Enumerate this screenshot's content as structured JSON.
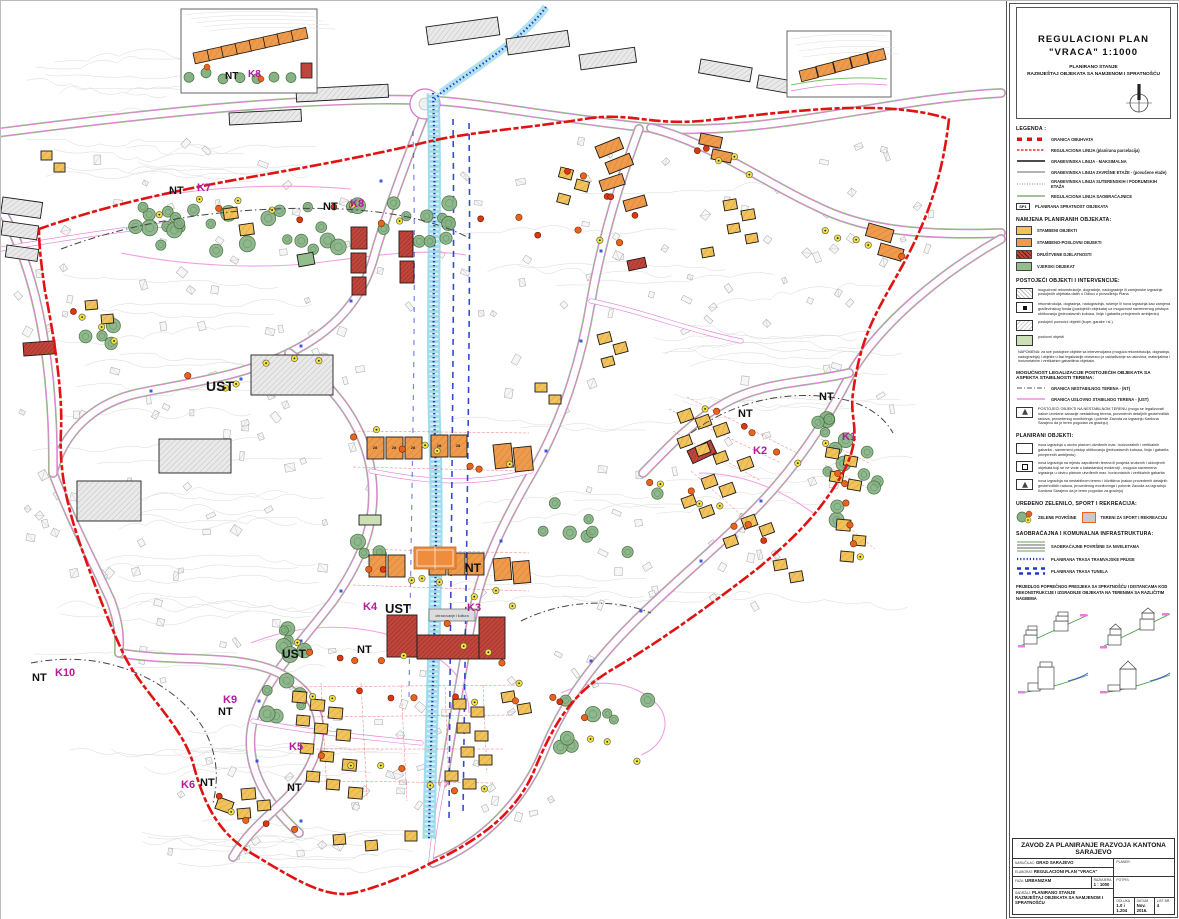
{
  "title_block": {
    "line1": "REGULACIONI  PLAN",
    "line2": "\"VRACA\"    1:1000",
    "line3": "PLANIRANO STANJE",
    "line4": "RAZMJEŠTAJ OBJEKATA SA NAMJENOM I SPRATNOŠĆU"
  },
  "legend": {
    "title": "LEGENDA :",
    "lines": [
      {
        "label": "GRANICA OBUHVATA"
      },
      {
        "label": "REGULACIONA LINIJA (planirana parcelacija)"
      },
      {
        "label": "GRAĐEVINSKA LINIJA - MAKSIMALNA"
      },
      {
        "label": "GRAĐEVINSKA LINIJA ZAVRŠNE ETAŽE - (povučene etaže)"
      },
      {
        "label": "GRAĐEVINSKA LINIJA SUTERENSKIH I PODRUMSKIH ETAŽA"
      },
      {
        "label": "REGULACIONA LINIJA SAOBRAĆAJNICE"
      }
    ],
    "sp1": {
      "tag": "SP1",
      "label": "PLANIRANA SPRATNOST OBJEKATA"
    }
  },
  "namjena": {
    "title": "NAMJENA PLANIRANIH OBJEKATA:",
    "items": [
      {
        "label": "STAMBENI  OBJEKTI",
        "color": "#F2C35A"
      },
      {
        "label": "STAMBENO-POSLOVNI  OBJEKTI",
        "color": "#F09A4B"
      },
      {
        "label": "DRUŠTVENE DJELATNOSTI",
        "color": "#C0463C"
      },
      {
        "label": "VJERSKI OBJEKAT",
        "color": "#93BD8C"
      }
    ]
  },
  "postojeci": {
    "title": "POSTOJEĆI OBJEKTI I INTERVENCIJE:",
    "items": [
      {
        "label": "mogućnost rekonstrukcije, dogradnje, nadogradnje ili zamjenske izgradnje postojećih objekata datih u Odluci o provođenju Plana"
      },
      {
        "label": "rekonstrukcija, dogradnja, nadogradnja, rušenje ili nova izgradnja kao zamjena građevinskog fonda (postojećih objekata) uz mogućnost savremenog pristupa oblikovanju (jednostavnih kubusa, linija i gabarita primjerenih ambijentu)"
      },
      {
        "label": "postojeći pomoćni objekti (šupe, garaže i sl.)"
      },
      {
        "label": "poslovni objekti"
      }
    ],
    "napomena": "NAPOMENA: za sve postojeće objekte sa intervencijama (moguća rekonstrukcija, dogradnja, nadogradnja) i objekte u fazi legalizacije obavezno je usklađivanje sa uslovima, materijalima i horizontalnim i vertikalnim gabaritima objekata."
  },
  "legalizacija": {
    "title": "MOGUĆNOST LEGALIZACIJE POSTOJEĆIH OBJEKATA SA ASPEKTA STABILNOSTI TERENA:",
    "nt": "GRANICA NESTABILNOG TERENA - (NT)",
    "ust": "GRANICA USLOVNO STABILNOG TERENA - (UST)",
    "item": "POSTOJEĆI OBJEKTI NA NESTABILNOM TERENU (mogu se legalizovati nakon izvršene sanacije nestabilnog terena, provedenih detaljnih geotehničkih radova, provedenog monitoringa i potvrde Zavoda za izgradnju Kantona Sarajevo da je teren pogodan za gradnju)"
  },
  "planirani": {
    "title": "PLANIRANI OBJEKTI:",
    "items": [
      {
        "label": "nova izgradnja u okviru planom utvrđenih max. horizontalnih i vertikalnih gabarita - savremeni pristup oblikovanju (jednostavnih kubusa, linija i gabarita primjerenih ambijentu)"
      },
      {
        "label": "nova izgradnja na mjestu zapuštenih terena ili posjeda srušenih i uklonjenih objekata koji se ne vode u katastarskoj evidenciji - moguća savremena izgradnja u okviru planom utvrđenih max. horizontalnih i vertikalnih gabarita"
      },
      {
        "label": "nova izgradnja na nestabilnom terenu i klizištima (nakon provedenih detaljnih geotehničkih radova, provedenog monitoringa i potvrde Zavoda za izgradnju Kantona Sarajevo da je teren pogodan za gradnju)"
      }
    ]
  },
  "zelenilo": {
    "title": "UREĐENO ZELENILO, SPORT I REKREACIJA:",
    "green": "ZELENE POVRŠINE",
    "sport": "TERENI ZA SPORT I REKREACIJU"
  },
  "saobracaj": {
    "title": "SAOBRAĆAJNA I KOMUNALNA INFRASTRUKTURA:",
    "items": [
      {
        "label": "SAOBRAĆAJNE POVRŠINE SA NIVELETAMA"
      },
      {
        "label": "PLANIRANA TRASA TRAMVAJSKE PRUGE"
      },
      {
        "label": "PLANIRANA TRASA TUNELA"
      }
    ]
  },
  "presjek": {
    "text": "PRIJEDLOG POPREČNOG PRESJEKA SA SPRATNOŠĆU I DISTANCAMA KOD REKONSTRUKCIJE I IZGRADNJE OBJEKATA NA TERENIMA SA RAZLIČITIM NAGIBIMA"
  },
  "footer": {
    "org": "ZAVOD ZA PLANIRANJE RAZVOJA KANTONA SARAJEVO",
    "narucilac_label": "NARUČILAC:",
    "narucilac": "GRAD SARAJEVO",
    "elaborat_label": "ELABORAT:",
    "elaborat": "REGULACIONI PLAN \"VRACA\"",
    "faza_label": "FAZA:",
    "faza": "URBANIZAM",
    "razmjera_label": "RAZMJERA",
    "razmjera": "1 : 1000",
    "sadrzaj_label": "SADRŽAJ:",
    "sadrzaj1": "PLANIRANO STANJE",
    "sadrzaj2": "RAZMJEŠTAJ OBJEKATA SA NAMJENOM I SPRATNOŠĆU",
    "planer_label": "PLANER:",
    "potpis_label": "POTPIS:",
    "odluka_label": "ODLUKA",
    "odluka": "1.0 i 1.204",
    "datum_label": "DATUM",
    "datum": "Nov. 2016.",
    "list_label": "LIST BR.",
    "list": "4"
  },
  "map": {
    "school_label": "obrazovanje i kultura",
    "unit_label": "28",
    "colors": {
      "boundary": "#E01212",
      "magenta_code": "#B5199E",
      "ust_line": "#EF8FE0",
      "tram_blue": "#2038C8",
      "stream": "#8FD6EA"
    },
    "labels": [
      {
        "text": "NT",
        "x": 168,
        "y": 193,
        "size": 11,
        "color": "#111"
      },
      {
        "text": "K7",
        "x": 196,
        "y": 190,
        "size": 11,
        "color": "#B5199E"
      },
      {
        "text": "NT",
        "x": 322,
        "y": 209,
        "size": 11,
        "color": "#111"
      },
      {
        "text": "K8",
        "x": 349,
        "y": 206,
        "size": 11,
        "color": "#B5199E"
      },
      {
        "text": "NT",
        "x": 224,
        "y": 78,
        "size": 10,
        "color": "#111"
      },
      {
        "text": "K8",
        "x": 247,
        "y": 76,
        "size": 10,
        "color": "#B5199E"
      },
      {
        "text": "UST",
        "x": 205,
        "y": 390,
        "size": 14,
        "color": "#111"
      },
      {
        "text": "NT",
        "x": 737,
        "y": 416,
        "size": 11,
        "color": "#111"
      },
      {
        "text": "NT",
        "x": 818,
        "y": 399,
        "size": 11,
        "color": "#111"
      },
      {
        "text": "K1",
        "x": 841,
        "y": 439,
        "size": 11,
        "color": "#B5199E"
      },
      {
        "text": "K2",
        "x": 752,
        "y": 453,
        "size": 11,
        "color": "#B5199E"
      },
      {
        "text": "NT",
        "x": 464,
        "y": 571,
        "size": 12,
        "color": "#111"
      },
      {
        "text": "K4",
        "x": 362,
        "y": 609,
        "size": 11,
        "color": "#B5199E"
      },
      {
        "text": "UST",
        "x": 384,
        "y": 612,
        "size": 13,
        "color": "#111"
      },
      {
        "text": "K3",
        "x": 466,
        "y": 610,
        "size": 11,
        "color": "#B5199E"
      },
      {
        "text": "UST",
        "x": 281,
        "y": 657,
        "size": 12,
        "color": "#111"
      },
      {
        "text": "NT",
        "x": 356,
        "y": 652,
        "size": 11,
        "color": "#111"
      },
      {
        "text": "K5",
        "x": 288,
        "y": 749,
        "size": 11,
        "color": "#B5199E"
      },
      {
        "text": "NT",
        "x": 31,
        "y": 680,
        "size": 11,
        "color": "#111"
      },
      {
        "text": "K10",
        "x": 54,
        "y": 675,
        "size": 11,
        "color": "#B5199E"
      },
      {
        "text": "K9",
        "x": 222,
        "y": 702,
        "size": 11,
        "color": "#B5199E"
      },
      {
        "text": "NT",
        "x": 217,
        "y": 714,
        "size": 11,
        "color": "#111"
      },
      {
        "text": "K6",
        "x": 180,
        "y": 787,
        "size": 11,
        "color": "#B5199E"
      },
      {
        "text": "NT",
        "x": 199,
        "y": 785,
        "size": 11,
        "color": "#111"
      },
      {
        "text": "NT",
        "x": 286,
        "y": 790,
        "size": 11,
        "color": "#111"
      }
    ]
  }
}
